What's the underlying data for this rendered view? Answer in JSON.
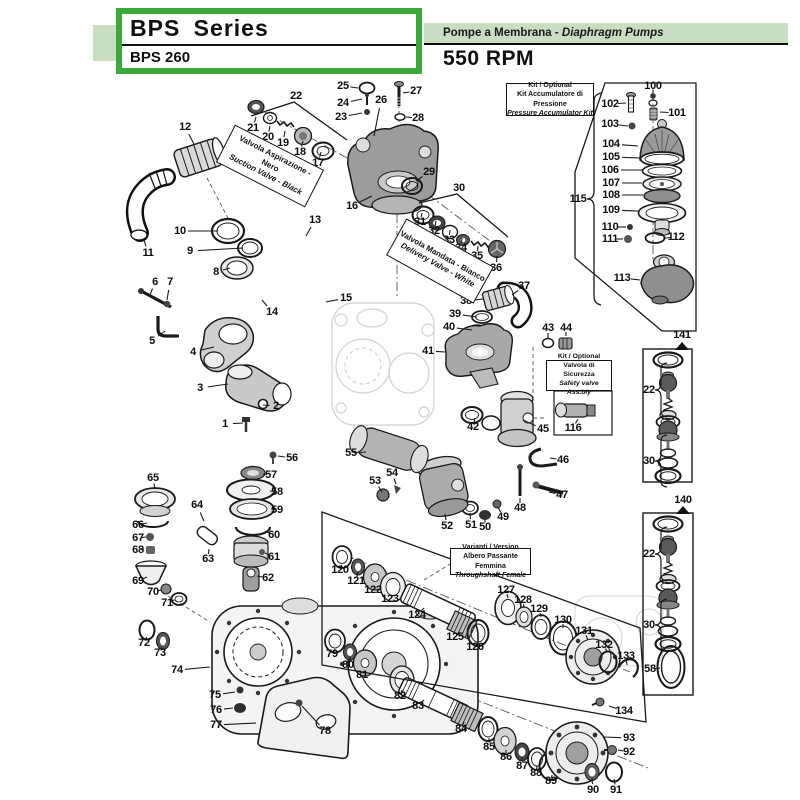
{
  "page": {
    "accent_green": "#3aa83d",
    "band_green": "#c8ddc2",
    "ink": "#1a1a1a"
  },
  "header": {
    "series_title": "BPS Series",
    "model": "BPS 260",
    "product_line_it": "Pompe a Membrana",
    "product_line_sep": " - ",
    "product_line_en": "Diaphragm Pumps",
    "speed": "550 RPM"
  },
  "labels": {
    "suction_valve": {
      "line1": "Valvola Aspirazione - Nero",
      "line2": "Suction Valve - Black"
    },
    "delivery_valve": {
      "line1": "Valvola Mandata - Bianco",
      "line2": "Delivery Valve - White"
    },
    "accumulator_kit": {
      "line1": "Kit / Optional",
      "line2": "Kit Accumulatore di Pressione",
      "line3": "Pressure Accumulator Kit"
    },
    "safety_valve_kit": {
      "line1": "Kit / Optional",
      "line2": "Valvola di Sicurezza",
      "line3": "Safety valve Ass.bly"
    },
    "throughshaft_variant": {
      "line1": "Varianti / Version",
      "line2": "Albero Passante Femmina",
      "line3": "Throughshaft Female"
    }
  },
  "diagram": {
    "callouts": [
      {
        "n": "1",
        "x": 225,
        "y": 424,
        "ex": 243,
        "ey": 423
      },
      {
        "n": "2",
        "x": 276,
        "y": 406,
        "ex": 263,
        "ey": 405
      },
      {
        "n": "3",
        "x": 200,
        "y": 388,
        "ex": 228,
        "ey": 384
      },
      {
        "n": "4",
        "x": 193,
        "y": 352,
        "ex": 214,
        "ey": 347
      },
      {
        "n": "5",
        "x": 152,
        "y": 341,
        "ex": 165,
        "ey": 331
      },
      {
        "n": "6",
        "x": 155,
        "y": 282,
        "ex": 150,
        "ey": 295
      },
      {
        "n": "7",
        "x": 170,
        "y": 282,
        "ex": 167,
        "ey": 300
      },
      {
        "n": "8",
        "x": 216,
        "y": 272,
        "ex": 230,
        "ey": 268
      },
      {
        "n": "9",
        "x": 190,
        "y": 251,
        "ex": 243,
        "ey": 248
      },
      {
        "n": "10",
        "x": 180,
        "y": 231,
        "ex": 218,
        "ey": 231
      },
      {
        "n": "11",
        "x": 148,
        "y": 253,
        "ex": 144,
        "ey": 240
      },
      {
        "n": "12",
        "x": 185,
        "y": 127,
        "ex": 194,
        "ey": 144
      },
      {
        "n": "13",
        "x": 315,
        "y": 220,
        "ex": 306,
        "ey": 236
      },
      {
        "n": "14",
        "x": 272,
        "y": 312,
        "ex": 262,
        "ey": 300
      },
      {
        "n": "15",
        "x": 346,
        "y": 298,
        "ex": 326,
        "ey": 302
      },
      {
        "n": "16",
        "x": 352,
        "y": 206,
        "ex": 372,
        "ey": 196
      },
      {
        "n": "17",
        "x": 318,
        "y": 163,
        "ex": 321,
        "ey": 152
      },
      {
        "n": "18",
        "x": 300,
        "y": 152,
        "ex": 303,
        "ey": 141
      },
      {
        "n": "19",
        "x": 283,
        "y": 143,
        "ex": 285,
        "ey": 131
      },
      {
        "n": "20",
        "x": 268,
        "y": 137,
        "ex": 270,
        "ey": 126
      },
      {
        "n": "21",
        "x": 253,
        "y": 128,
        "ex": 256,
        "ey": 117
      },
      {
        "n": "22",
        "x": 296,
        "y": 96
      },
      {
        "n": "23",
        "x": 341,
        "y": 117,
        "ex": 362,
        "ey": 113
      },
      {
        "n": "24",
        "x": 343,
        "y": 103,
        "ex": 362,
        "ey": 99
      },
      {
        "n": "25",
        "x": 343,
        "y": 86,
        "ex": 358,
        "ey": 88
      },
      {
        "n": "26",
        "x": 381,
        "y": 100,
        "ex": 374,
        "ey": 136
      },
      {
        "n": "27",
        "x": 416,
        "y": 91,
        "ex": 403,
        "ey": 93
      },
      {
        "n": "28",
        "x": 418,
        "y": 118,
        "ex": 406,
        "ey": 117
      },
      {
        "n": "29",
        "x": 429,
        "y": 172,
        "ex": 416,
        "ey": 181
      },
      {
        "n": "30",
        "x": 459,
        "y": 188
      },
      {
        "n": "31",
        "x": 420,
        "y": 222,
        "ex": 422,
        "ey": 213
      },
      {
        "n": "32",
        "x": 434,
        "y": 231,
        "ex": 436,
        "ey": 221
      },
      {
        "n": "33",
        "x": 449,
        "y": 240,
        "ex": 450,
        "ey": 230
      },
      {
        "n": "34",
        "x": 461,
        "y": 248,
        "ex": 462,
        "ey": 238
      },
      {
        "n": "35",
        "x": 477,
        "y": 256,
        "ex": 478,
        "ey": 246
      },
      {
        "n": "36",
        "x": 496,
        "y": 268,
        "ex": 497,
        "ey": 256
      },
      {
        "n": "37",
        "x": 524,
        "y": 286,
        "ex": 512,
        "ey": 295
      },
      {
        "n": "38",
        "x": 466,
        "y": 301,
        "ex": 483,
        "ey": 299
      },
      {
        "n": "39",
        "x": 455,
        "y": 314,
        "ex": 477,
        "ey": 317
      },
      {
        "n": "40",
        "x": 449,
        "y": 327,
        "ex": 472,
        "ey": 330
      },
      {
        "n": "41",
        "x": 428,
        "y": 351,
        "ex": 445,
        "ey": 352
      },
      {
        "n": "42",
        "x": 473,
        "y": 427,
        "ex": 475,
        "ey": 418
      },
      {
        "n": "43",
        "x": 548,
        "y": 328,
        "ex": 548,
        "ey": 338
      },
      {
        "n": "44",
        "x": 566,
        "y": 328,
        "ex": 566,
        "ey": 336
      },
      {
        "n": "45",
        "x": 543,
        "y": 429,
        "ex": 523,
        "ey": 420
      },
      {
        "n": "46",
        "x": 563,
        "y": 460,
        "ex": 550,
        "ey": 458
      },
      {
        "n": "47",
        "x": 562,
        "y": 495,
        "ex": 549,
        "ey": 492
      },
      {
        "n": "48",
        "x": 520,
        "y": 508,
        "ex": 520,
        "ey": 498
      },
      {
        "n": "49",
        "x": 503,
        "y": 517,
        "ex": 498,
        "ey": 507
      },
      {
        "n": "50",
        "x": 485,
        "y": 527,
        "ex": 485,
        "ey": 518
      },
      {
        "n": "51",
        "x": 471,
        "y": 525,
        "ex": 470,
        "ey": 513
      },
      {
        "n": "52",
        "x": 447,
        "y": 526,
        "ex": 445,
        "ey": 514
      },
      {
        "n": "53",
        "x": 375,
        "y": 481,
        "ex": 382,
        "ey": 492
      },
      {
        "n": "54",
        "x": 392,
        "y": 473,
        "ex": 396,
        "ey": 484
      },
      {
        "n": "55",
        "x": 351,
        "y": 453,
        "ex": 366,
        "ey": 452
      },
      {
        "n": "56",
        "x": 292,
        "y": 458,
        "ex": 278,
        "ey": 456
      },
      {
        "n": "57",
        "x": 271,
        "y": 475,
        "ex": 263,
        "ey": 474
      },
      {
        "n": "58",
        "x": 277,
        "y": 492,
        "ex": 270,
        "ey": 491
      },
      {
        "n": "59",
        "x": 277,
        "y": 510,
        "ex": 271,
        "ey": 509
      },
      {
        "n": "60",
        "x": 274,
        "y": 535,
        "ex": 267,
        "ey": 532
      },
      {
        "n": "61",
        "x": 274,
        "y": 557,
        "ex": 265,
        "ey": 553
      },
      {
        "n": "62",
        "x": 268,
        "y": 578,
        "ex": 257,
        "ey": 576
      },
      {
        "n": "63",
        "x": 208,
        "y": 559,
        "ex": 209,
        "ey": 549
      },
      {
        "n": "64",
        "x": 197,
        "y": 505,
        "ex": 204,
        "ey": 521
      },
      {
        "n": "65",
        "x": 153,
        "y": 478,
        "ex": 155,
        "ey": 489
      },
      {
        "n": "66",
        "x": 138,
        "y": 525,
        "ex": 147,
        "ey": 523
      },
      {
        "n": "67",
        "x": 138,
        "y": 538,
        "ex": 146,
        "ey": 537
      },
      {
        "n": "68",
        "x": 138,
        "y": 550,
        "ex": 144,
        "ey": 549
      },
      {
        "n": "69",
        "x": 138,
        "y": 581,
        "ex": 147,
        "ey": 577
      },
      {
        "n": "70",
        "x": 153,
        "y": 592,
        "ex": 161,
        "ey": 590
      },
      {
        "n": "71",
        "x": 167,
        "y": 603,
        "ex": 174,
        "ey": 600
      },
      {
        "n": "72",
        "x": 144,
        "y": 643,
        "ex": 147,
        "ey": 637
      },
      {
        "n": "73",
        "x": 160,
        "y": 653,
        "ex": 162,
        "ey": 647
      },
      {
        "n": "74",
        "x": 177,
        "y": 670,
        "ex": 210,
        "ey": 667
      },
      {
        "n": "75",
        "x": 215,
        "y": 695,
        "ex": 235,
        "ey": 692
      },
      {
        "n": "76",
        "x": 216,
        "y": 710,
        "ex": 233,
        "ey": 708
      },
      {
        "n": "77",
        "x": 216,
        "y": 725,
        "ex": 256,
        "ey": 723
      },
      {
        "n": "78",
        "x": 325,
        "y": 731,
        "ex": 302,
        "ey": 706
      },
      {
        "n": "79",
        "x": 332,
        "y": 654,
        "ex": 335,
        "ey": 649
      },
      {
        "n": "80",
        "x": 348,
        "y": 665,
        "ex": 350,
        "ey": 657
      },
      {
        "n": "81",
        "x": 362,
        "y": 675,
        "ex": 364,
        "ey": 672
      },
      {
        "n": "82",
        "x": 400,
        "y": 696,
        "ex": 402,
        "ey": 690
      },
      {
        "n": "83",
        "x": 418,
        "y": 706,
        "ex": 424,
        "ey": 700
      },
      {
        "n": "84",
        "x": 461,
        "y": 729,
        "ex": 464,
        "ey": 722
      },
      {
        "n": "85",
        "x": 489,
        "y": 747,
        "ex": 489,
        "ey": 738
      },
      {
        "n": "86",
        "x": 506,
        "y": 757,
        "ex": 506,
        "ey": 750
      },
      {
        "n": "87",
        "x": 522,
        "y": 766,
        "ex": 522,
        "ey": 757
      },
      {
        "n": "88",
        "x": 536,
        "y": 773,
        "ex": 537,
        "ey": 766
      },
      {
        "n": "89",
        "x": 551,
        "y": 781,
        "ex": 552,
        "ey": 775
      },
      {
        "n": "90",
        "x": 593,
        "y": 790,
        "ex": 592,
        "ey": 778
      },
      {
        "n": "91",
        "x": 616,
        "y": 790,
        "ex": 614,
        "ey": 779
      },
      {
        "n": "92",
        "x": 629,
        "y": 752,
        "ex": 618,
        "ey": 750
      },
      {
        "n": "93",
        "x": 629,
        "y": 738,
        "ex": 604,
        "ey": 737
      },
      {
        "n": "100",
        "x": 653,
        "y": 86,
        "ex": 653,
        "ey": 93
      },
      {
        "n": "101",
        "x": 677,
        "y": 113,
        "ex": 660,
        "ey": 112
      },
      {
        "n": "102",
        "x": 610,
        "y": 104,
        "ex": 626,
        "ey": 103
      },
      {
        "n": "103",
        "x": 610,
        "y": 124,
        "ex": 628,
        "ey": 126
      },
      {
        "n": "104",
        "x": 611,
        "y": 144,
        "ex": 638,
        "ey": 146
      },
      {
        "n": "105",
        "x": 611,
        "y": 157,
        "ex": 640,
        "ey": 158
      },
      {
        "n": "106",
        "x": 610,
        "y": 170,
        "ex": 642,
        "ey": 170
      },
      {
        "n": "107",
        "x": 611,
        "y": 183,
        "ex": 642,
        "ey": 183
      },
      {
        "n": "108",
        "x": 611,
        "y": 195,
        "ex": 643,
        "ey": 195
      },
      {
        "n": "109",
        "x": 611,
        "y": 210,
        "ex": 638,
        "ey": 211
      },
      {
        "n": "110",
        "x": 610,
        "y": 227,
        "ex": 626,
        "ey": 227
      },
      {
        "n": "111",
        "x": 610,
        "y": 239,
        "ex": 623,
        "ey": 239
      },
      {
        "n": "112",
        "x": 676,
        "y": 237,
        "ex": 665,
        "ey": 238
      },
      {
        "n": "113",
        "x": 622,
        "y": 278,
        "ex": 640,
        "ey": 280
      },
      {
        "n": "115",
        "x": 578,
        "y": 199
      },
      {
        "n": "116",
        "x": 573,
        "y": 428,
        "ex": 578,
        "ey": 419
      },
      {
        "n": "120",
        "x": 340,
        "y": 570,
        "ex": 342,
        "ey": 565
      },
      {
        "n": "121",
        "x": 356,
        "y": 581,
        "ex": 358,
        "ey": 572
      },
      {
        "n": "122",
        "x": 373,
        "y": 590,
        "ex": 375,
        "ey": 587
      },
      {
        "n": "123",
        "x": 390,
        "y": 599,
        "ex": 392,
        "ey": 597
      },
      {
        "n": "124",
        "x": 417,
        "y": 615,
        "ex": 424,
        "ey": 608
      },
      {
        "n": "125",
        "x": 455,
        "y": 637,
        "ex": 459,
        "ey": 632
      },
      {
        "n": "126",
        "x": 475,
        "y": 647,
        "ex": 477,
        "ey": 643
      },
      {
        "n": "127",
        "x": 506,
        "y": 590,
        "ex": 508,
        "ey": 598
      },
      {
        "n": "128",
        "x": 523,
        "y": 600,
        "ex": 524,
        "ey": 608
      },
      {
        "n": "129",
        "x": 539,
        "y": 609,
        "ex": 541,
        "ey": 617
      },
      {
        "n": "130",
        "x": 563,
        "y": 620,
        "ex": 563,
        "ey": 628
      },
      {
        "n": "131",
        "x": 584,
        "y": 631,
        "ex": 588,
        "ey": 640
      },
      {
        "n": "132",
        "x": 604,
        "y": 645,
        "ex": 607,
        "ey": 652
      },
      {
        "n": "133",
        "x": 626,
        "y": 656,
        "ex": 627,
        "ey": 665
      },
      {
        "n": "134",
        "x": 624,
        "y": 711,
        "ex": 609,
        "ey": 706
      },
      {
        "n": "140",
        "x": 683,
        "y": 500
      },
      {
        "n": "141",
        "x": 682,
        "y": 335
      },
      {
        "n": "22",
        "x": 649,
        "y": 390
      },
      {
        "n": "30",
        "x": 649,
        "y": 461
      },
      {
        "n": "22",
        "x": 649,
        "y": 554
      },
      {
        "n": "30",
        "x": 649,
        "y": 625
      },
      {
        "n": "58",
        "x": 650,
        "y": 669,
        "ex": 660,
        "ey": 668
      }
    ]
  }
}
